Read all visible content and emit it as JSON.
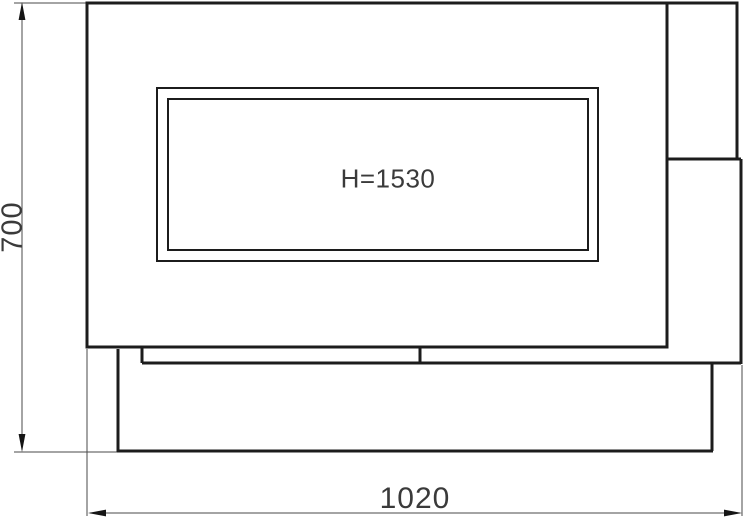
{
  "drawing": {
    "type": "technical-dimension-drawing",
    "labels": {
      "height_dimension": "700",
      "width_dimension": "1020",
      "window_text": "H=1530"
    },
    "colors": {
      "background": "#ffffff",
      "structural_line": "#1c1c1c",
      "dimension_line": "#4a4a4a",
      "label_text": "#3a3a3a"
    }
  }
}
